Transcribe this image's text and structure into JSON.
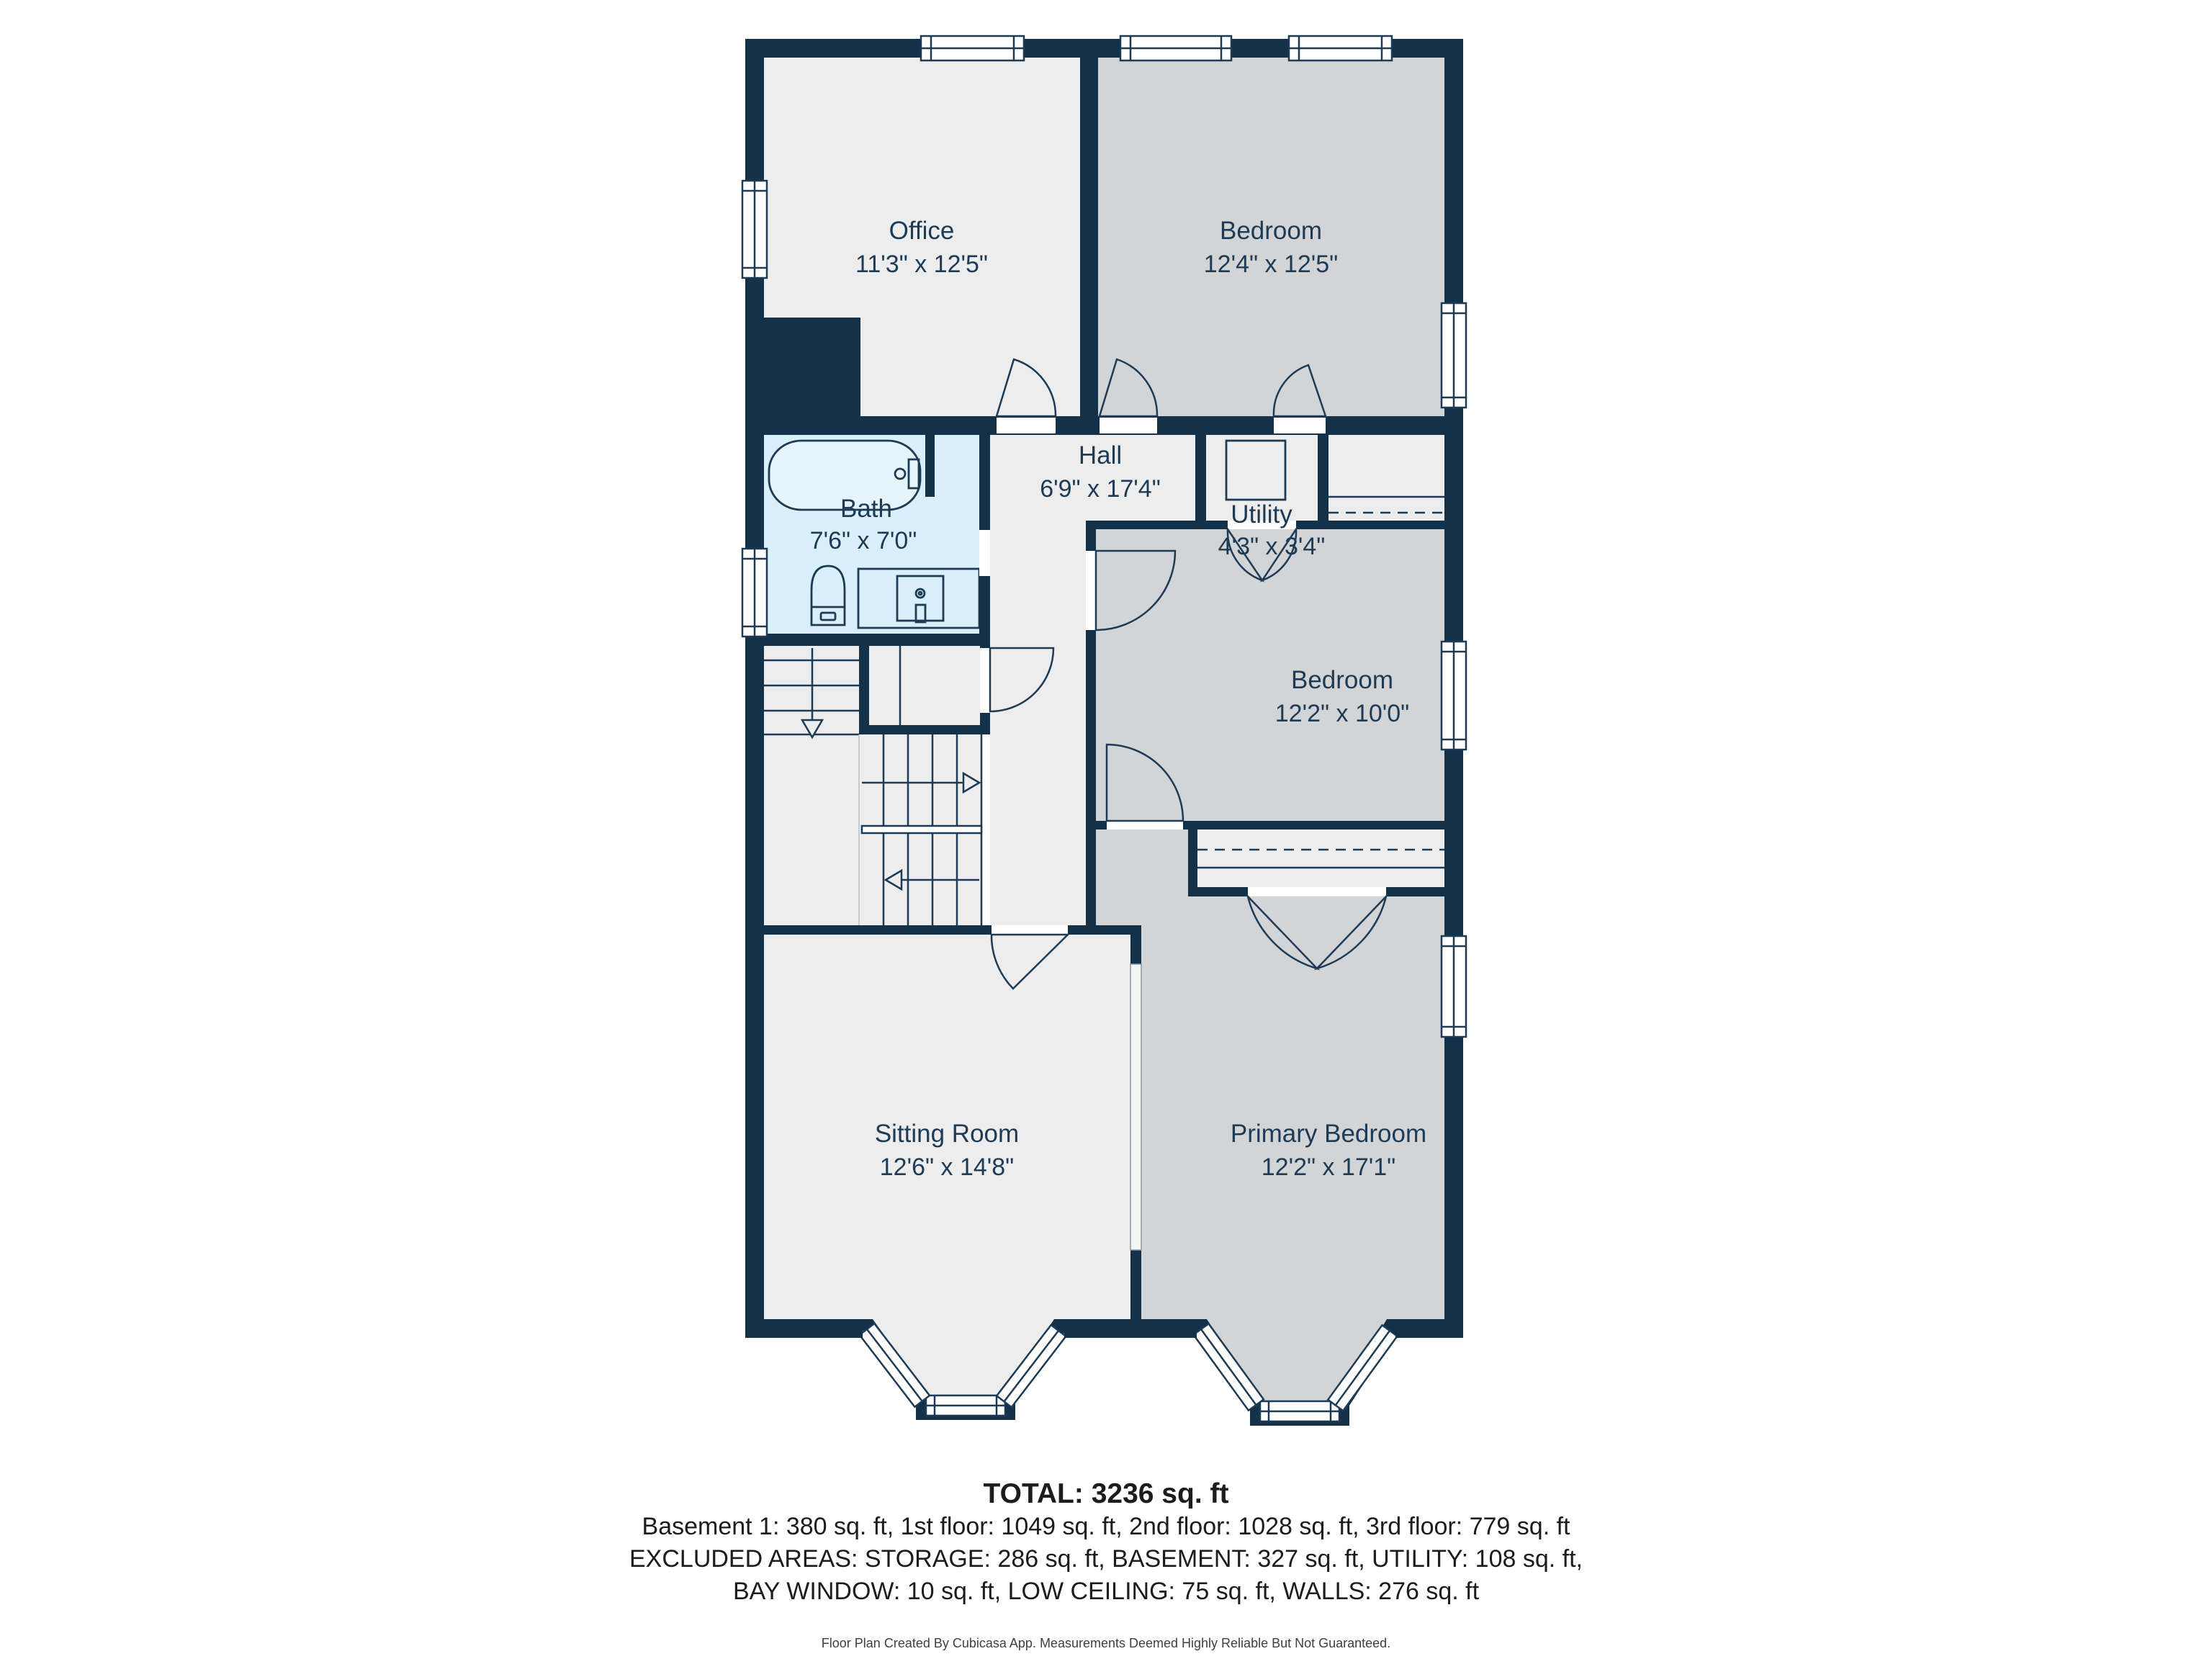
{
  "plan": {
    "rooms": {
      "office": {
        "name": "Office",
        "dims": "11'3\" x 12'5\""
      },
      "bedroom_top": {
        "name": "Bedroom",
        "dims": "12'4\" x 12'5\""
      },
      "bath": {
        "name": "Bath",
        "dims": "7'6\" x 7'0\""
      },
      "hall": {
        "name": "Hall",
        "dims": "6'9\" x 17'4\""
      },
      "utility": {
        "name": "Utility",
        "dims": "4'3\" x 3'4\""
      },
      "bedroom_mid": {
        "name": "Bedroom",
        "dims": "12'2\" x 10'0\""
      },
      "sitting": {
        "name": "Sitting Room",
        "dims": "12'6\" x 14'8\""
      },
      "primary": {
        "name": "Primary Bedroom",
        "dims": "12'2\" x 17'1\""
      }
    },
    "colors": {
      "wall": "#133149",
      "floor_light": "#ededee",
      "floor_gray": "#d3d4d6",
      "floor_bath": "#d9f0fa",
      "label": "#1d3b55",
      "line": "#1d3b55"
    }
  },
  "summary": {
    "total": "TOTAL: 3236 sq. ft",
    "floors": "Basement 1: 380 sq. ft, 1st floor: 1049 sq. ft, 2nd floor: 1028 sq. ft, 3rd floor: 779 sq. ft",
    "excluded1": "EXCLUDED AREAS: STORAGE: 286 sq. ft, BASEMENT: 327 sq. ft, UTILITY: 108 sq. ft,",
    "excluded2": "BAY WINDOW: 10 sq. ft, LOW CEILING: 75 sq. ft, WALLS: 276 sq. ft",
    "footer": "Floor Plan Created By Cubicasa App. Measurements Deemed Highly Reliable But Not Guaranteed."
  }
}
